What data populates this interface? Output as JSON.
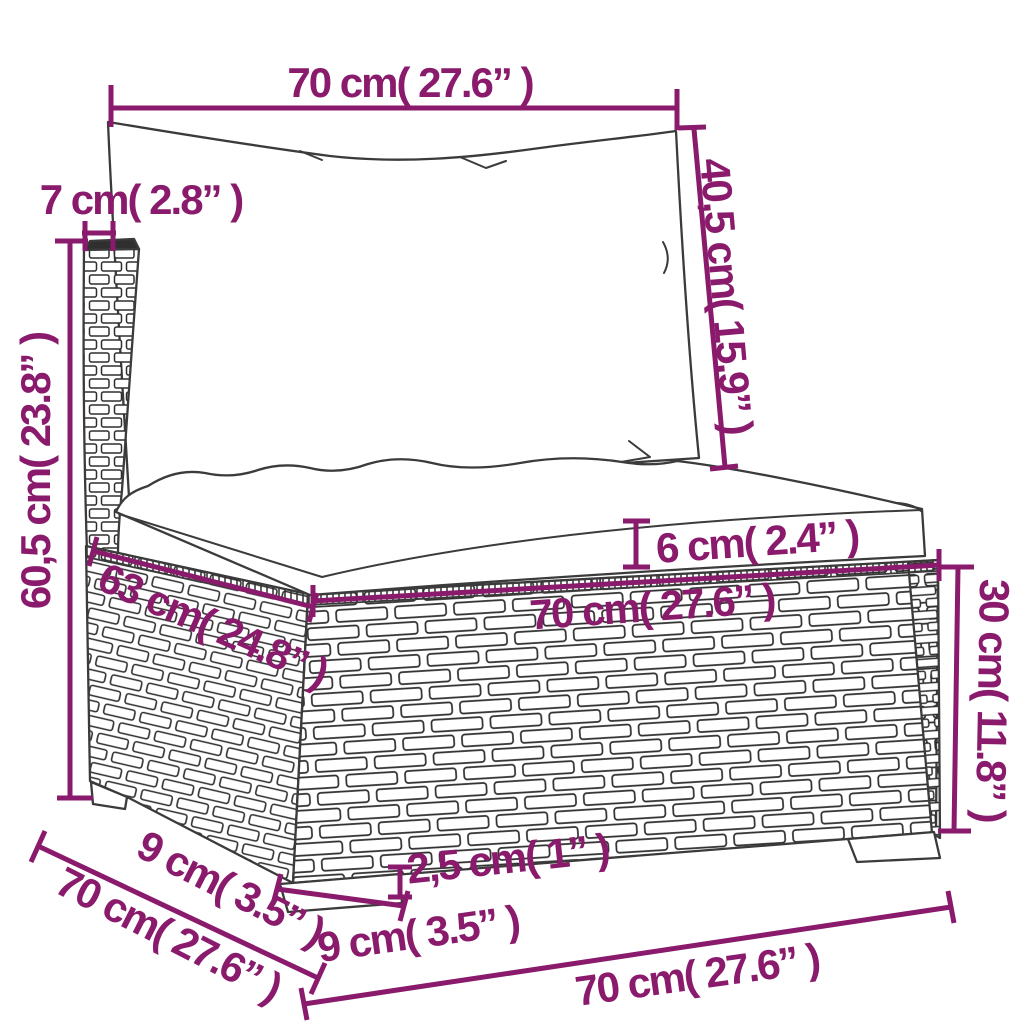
{
  "diagram": {
    "title": "Poly rattan sectional sofa middle section - dimension drawing",
    "style": {
      "accent_color": "#8a1a6c",
      "outline_color": "#3b3b3b",
      "background_color": "#ffffff"
    },
    "units": [
      "cm",
      "inches"
    ],
    "dimensions": [
      {
        "id": "back-cushion-width",
        "label": "70 cm( 27.6” )"
      },
      {
        "id": "back-cushion-height",
        "label": "40,5 cm( 15.9” )"
      },
      {
        "id": "back-post-width",
        "label": "7 cm( 2.8” )"
      },
      {
        "id": "total-height",
        "label": "60,5 cm( 23.8” )"
      },
      {
        "id": "seat-cushion-thickness",
        "label": "6 cm( 2.4” )"
      },
      {
        "id": "base-top-depth",
        "label": "63 cm( 24.8” )"
      },
      {
        "id": "base-front-width",
        "label": "70 cm( 27.6” )"
      },
      {
        "id": "base-height",
        "label": "30 cm( 11.8” )"
      },
      {
        "id": "leg-height",
        "label": "2,5 cm( 1” )"
      },
      {
        "id": "front-leg-width",
        "label": "9 cm( 3.5” )"
      },
      {
        "id": "side-leg-width",
        "label": "9 cm( 3.5” )"
      },
      {
        "id": "total-depth",
        "label": "70 cm( 27.6” )"
      },
      {
        "id": "bottom-front-width",
        "label": "70 cm( 27.6” )"
      }
    ]
  }
}
